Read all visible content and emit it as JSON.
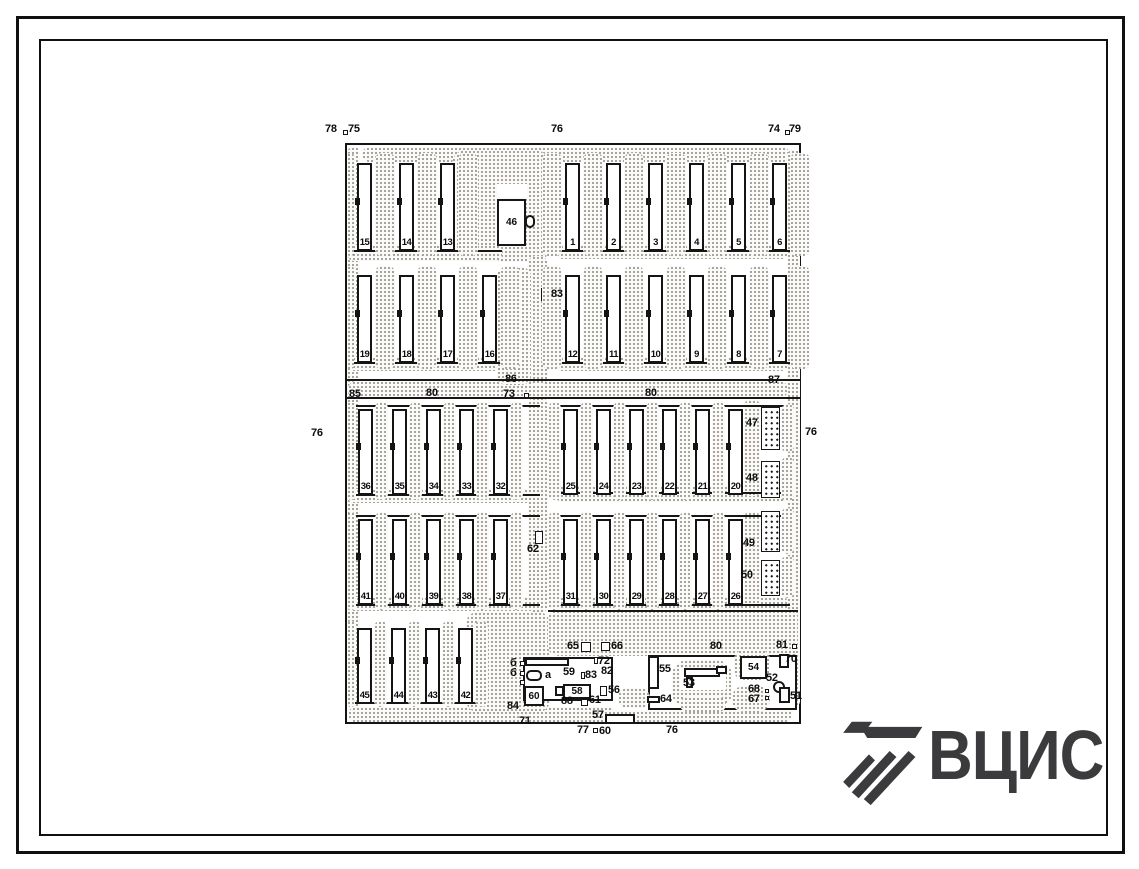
{
  "logo": {
    "text": "ВЦИС",
    "color": "#3b3b3e"
  },
  "colors": {
    "ink": "#141414",
    "paper": "#ffffff",
    "stipple": "#878787"
  },
  "plan": {
    "shapes": [
      {
        "t": "pframe",
        "n": "site-boundary",
        "b": [
          345,
          143,
          456,
          581
        ]
      },
      {
        "t": "stip",
        "n": "road-top",
        "b": [
          362,
          147,
          428,
          15,
          8
        ]
      },
      {
        "t": "stip",
        "n": "road-left",
        "b": [
          347,
          147,
          13,
          562,
          6
        ]
      },
      {
        "t": "stip",
        "n": "road-right",
        "b": [
          787,
          150,
          13,
          557,
          6
        ]
      },
      {
        "t": "stip",
        "n": "road-bottom",
        "b": [
          348,
          707,
          444,
          15,
          8
        ]
      },
      {
        "t": "stip",
        "n": "road-mid",
        "b": [
          348,
          381,
          440,
          17,
          8
        ]
      },
      {
        "t": "stip",
        "n": "plaza-top",
        "b": [
          452,
          150,
          97,
          112,
          14
        ]
      },
      {
        "t": "stip",
        "n": "road-center-upper",
        "b": [
          528,
          256,
          20,
          128,
          8
        ]
      },
      {
        "t": "stip",
        "n": "road-center-lower",
        "b": [
          528,
          397,
          20,
          216,
          8
        ]
      },
      {
        "t": "stip",
        "b": [
          348,
          245,
          154,
          16,
          6
        ]
      },
      {
        "t": "stip",
        "b": [
          556,
          245,
          232,
          14,
          6
        ]
      },
      {
        "t": "stip",
        "b": [
          348,
          357,
          154,
          14,
          6
        ]
      },
      {
        "t": "stip",
        "b": [
          556,
          357,
          232,
          14,
          6
        ]
      },
      {
        "t": "stip",
        "b": [
          497,
          267,
          34,
          118,
          10
        ]
      },
      {
        "t": "stip",
        "b": [
          348,
          489,
          190,
          14,
          6
        ]
      },
      {
        "t": "stip",
        "b": [
          556,
          486,
          232,
          16,
          6
        ]
      },
      {
        "t": "stip",
        "b": [
          348,
          597,
          190,
          14,
          6
        ]
      },
      {
        "t": "stip",
        "b": [
          556,
          597,
          232,
          14,
          6
        ]
      },
      {
        "t": "stip",
        "b": [
          744,
          400,
          16,
          96,
          6
        ]
      },
      {
        "t": "stip",
        "b": [
          744,
          512,
          16,
          94,
          6
        ]
      },
      {
        "t": "stip",
        "n": "plaza-bottom-left",
        "b": [
          466,
          612,
          84,
          100,
          12
        ]
      },
      {
        "t": "stip",
        "n": "service-area",
        "b": [
          548,
          610,
          250,
          46,
          10
        ]
      },
      {
        "t": "line",
        "b": [
          345,
          379,
          456,
          2
        ]
      },
      {
        "t": "line",
        "b": [
          345,
          397,
          456,
          2
        ]
      },
      {
        "t": "line",
        "b": [
          350,
          250,
          152,
          2
        ]
      },
      {
        "t": "line",
        "b": [
          556,
          250,
          234,
          2
        ]
      },
      {
        "t": "line",
        "b": [
          350,
          362,
          152,
          2
        ]
      },
      {
        "t": "line",
        "b": [
          556,
          362,
          234,
          2
        ]
      },
      {
        "t": "line",
        "b": [
          350,
          405,
          190,
          2
        ]
      },
      {
        "t": "line",
        "b": [
          556,
          405,
          234,
          2
        ]
      },
      {
        "t": "line",
        "b": [
          350,
          494,
          190,
          2
        ]
      },
      {
        "t": "line",
        "b": [
          556,
          492,
          234,
          2
        ]
      },
      {
        "t": "line",
        "b": [
          350,
          515,
          190,
          2
        ]
      },
      {
        "t": "line",
        "b": [
          556,
          515,
          234,
          2
        ]
      },
      {
        "t": "line",
        "b": [
          350,
          604,
          190,
          2
        ]
      },
      {
        "t": "line",
        "b": [
          556,
          604,
          234,
          2
        ]
      },
      {
        "t": "line",
        "b": [
          350,
          702,
          128,
          2
        ]
      },
      {
        "t": "line",
        "b": [
          548,
          610,
          250,
          2
        ]
      },
      {
        "t": "hatch",
        "n": "pen-47",
        "b": [
          761,
          407,
          19,
          43
        ]
      },
      {
        "t": "hatch",
        "n": "pen-48",
        "b": [
          761,
          461,
          19,
          37
        ]
      },
      {
        "t": "hatch",
        "n": "pen-49",
        "b": [
          761,
          511,
          19,
          41
        ]
      },
      {
        "t": "hatch",
        "n": "pen-50",
        "b": [
          761,
          560,
          19,
          36
        ]
      },
      {
        "t": "stip",
        "b": [
          781,
          404,
          13,
          48,
          7
        ]
      },
      {
        "t": "stip",
        "b": [
          781,
          457,
          13,
          44,
          7
        ]
      },
      {
        "t": "stip",
        "b": [
          781,
          508,
          13,
          46,
          7
        ]
      },
      {
        "t": "stip",
        "b": [
          781,
          556,
          13,
          42,
          7
        ]
      },
      {
        "t": "wrect",
        "b": [
          497,
          184,
          30,
          13
        ]
      },
      {
        "t": "box",
        "n": "building-46",
        "b": [
          497,
          199,
          29,
          47
        ],
        "label": "46"
      },
      {
        "t": "box",
        "b": [
          525,
          215,
          10,
          13,
          5
        ]
      },
      {
        "t": "box",
        "n": "compound-left",
        "b": [
          523,
          657,
          90,
          44
        ]
      },
      {
        "t": "wrect",
        "b": [
          613,
          656,
          36,
          54
        ]
      },
      {
        "t": "box",
        "n": "compound-right",
        "b": [
          648,
          655,
          149,
          55
        ]
      },
      {
        "t": "stip",
        "b": [
          672,
          660,
          60,
          48,
          16
        ]
      },
      {
        "t": "wrect",
        "b": [
          680,
          668,
          46,
          22
        ]
      },
      {
        "t": "stip",
        "b": [
          734,
          650,
          36,
          30,
          10
        ]
      },
      {
        "t": "stip",
        "b": [
          732,
          686,
          38,
          26,
          12
        ]
      },
      {
        "t": "stip",
        "b": [
          680,
          697,
          46,
          15,
          8
        ]
      },
      {
        "t": "stip",
        "b": [
          618,
          688,
          32,
          20,
          10
        ]
      },
      {
        "t": "box",
        "n": "building-55",
        "b": [
          648,
          656,
          11,
          33
        ]
      },
      {
        "t": "box",
        "n": "building-53",
        "b": [
          684,
          668,
          36,
          9
        ]
      },
      {
        "t": "box",
        "b": [
          686,
          677,
          7,
          11
        ]
      },
      {
        "t": "box",
        "b": [
          716,
          666,
          11,
          8
        ]
      },
      {
        "t": "box",
        "n": "building-54",
        "b": [
          740,
          656,
          27,
          23
        ],
        "label": "54"
      },
      {
        "t": "box",
        "n": "building-52",
        "b": [
          773,
          681,
          12,
          12,
          7
        ]
      },
      {
        "t": "box",
        "n": "building-51",
        "b": [
          779,
          687,
          11,
          16
        ]
      },
      {
        "t": "box",
        "n": "building-70",
        "b": [
          779,
          654,
          10,
          14
        ]
      },
      {
        "t": "box",
        "n": "building-64",
        "b": [
          647,
          696,
          13,
          7
        ]
      },
      {
        "t": "box",
        "n": "building-57",
        "b": [
          605,
          714,
          30,
          10
        ]
      },
      {
        "t": "box",
        "b": [
          525,
          658,
          44,
          8
        ]
      },
      {
        "t": "box",
        "n": "item-a",
        "b": [
          526,
          670,
          16,
          11,
          5
        ]
      },
      {
        "t": "box",
        "b": [
          555,
          686,
          9,
          10
        ]
      },
      {
        "t": "box",
        "n": "building-58",
        "b": [
          563,
          684,
          28,
          15
        ],
        "label": "58"
      },
      {
        "t": "box",
        "n": "building-60",
        "b": [
          524,
          686,
          20,
          20
        ],
        "label": "60"
      },
      {
        "t": "sq",
        "b": [
          343,
          130,
          5,
          5
        ]
      },
      {
        "t": "sq",
        "b": [
          785,
          130,
          5,
          5
        ]
      },
      {
        "t": "sq",
        "n": "marker-83",
        "b": [
          541,
          288,
          8,
          13
        ]
      },
      {
        "t": "sq",
        "n": "marker-62",
        "b": [
          535,
          531,
          8,
          13
        ]
      },
      {
        "t": "sq",
        "b": [
          524,
          393,
          5,
          5
        ]
      },
      {
        "t": "sq",
        "b": [
          792,
          644,
          5,
          5
        ]
      },
      {
        "t": "sq",
        "n": "marker-65",
        "b": [
          581,
          642,
          10,
          10
        ]
      },
      {
        "t": "sq",
        "n": "marker-66",
        "b": [
          601,
          642,
          9,
          9
        ]
      },
      {
        "t": "sq",
        "b": [
          594,
          657,
          4,
          7
        ]
      },
      {
        "t": "sq",
        "b": [
          581,
          672,
          4,
          7
        ]
      },
      {
        "t": "sq",
        "n": "marker-56",
        "b": [
          600,
          686,
          7,
          10
        ]
      },
      {
        "t": "sq",
        "b": [
          520,
          661,
          5,
          5
        ]
      },
      {
        "t": "sq",
        "b": [
          520,
          671,
          5,
          5
        ]
      },
      {
        "t": "sq",
        "b": [
          520,
          680,
          5,
          5
        ]
      },
      {
        "t": "sq",
        "b": [
          581,
          699,
          7,
          7
        ]
      },
      {
        "t": "sq",
        "b": [
          593,
          728,
          5,
          5
        ]
      },
      {
        "t": "sq",
        "b": [
          765,
          689,
          4,
          4
        ]
      },
      {
        "t": "sq",
        "b": [
          765,
          696,
          4,
          4
        ]
      }
    ],
    "groups": [
      {
        "y": 163,
        "h": 88,
        "cy": 153,
        "ch": 103,
        "bw": 15,
        "cw": 20,
        "pad": 3,
        "nums": [
          [
            "15",
            357
          ],
          [
            "14",
            399
          ],
          [
            "13",
            440
          ]
        ]
      },
      {
        "y": 163,
        "h": 88,
        "cy": 153,
        "ch": 103,
        "bw": 15,
        "cw": 20,
        "pad": 3,
        "nums": [
          [
            "1",
            565
          ],
          [
            "2",
            606
          ],
          [
            "3",
            648
          ],
          [
            "4",
            689
          ],
          [
            "5",
            731
          ],
          [
            "6",
            772
          ]
        ]
      },
      {
        "y": 275,
        "h": 88,
        "cy": 266,
        "ch": 103,
        "bw": 15,
        "cw": 20,
        "pad": 3,
        "nums": [
          [
            "19",
            357
          ],
          [
            "18",
            399
          ],
          [
            "17",
            440
          ],
          [
            "16",
            482
          ]
        ]
      },
      {
        "y": 275,
        "h": 88,
        "cy": 266,
        "ch": 103,
        "bw": 15,
        "cw": 20,
        "pad": 3,
        "nums": [
          [
            "12",
            565
          ],
          [
            "11",
            606
          ],
          [
            "10",
            648
          ],
          [
            "9",
            689
          ],
          [
            "8",
            731
          ],
          [
            "7",
            772
          ]
        ]
      },
      {
        "y": 409,
        "h": 86,
        "cy": 402,
        "ch": 98,
        "bw": 15,
        "cw": 13,
        "pad": 2,
        "nums": [
          [
            "36",
            358
          ],
          [
            "35",
            392
          ],
          [
            "34",
            426
          ],
          [
            "33",
            459
          ],
          [
            "32",
            493
          ]
        ]
      },
      {
        "y": 409,
        "h": 86,
        "cy": 402,
        "ch": 98,
        "bw": 15,
        "cw": 13,
        "pad": 2,
        "noTail": true,
        "nums": [
          [
            "25",
            563
          ],
          [
            "24",
            596
          ],
          [
            "23",
            629
          ],
          [
            "22",
            662
          ],
          [
            "21",
            695
          ],
          [
            "20",
            728
          ]
        ]
      },
      {
        "y": 519,
        "h": 86,
        "cy": 512,
        "ch": 98,
        "bw": 15,
        "cw": 13,
        "pad": 2,
        "nums": [
          [
            "41",
            358
          ],
          [
            "40",
            392
          ],
          [
            "39",
            426
          ],
          [
            "38",
            459
          ],
          [
            "37",
            493
          ]
        ]
      },
      {
        "y": 519,
        "h": 86,
        "cy": 512,
        "ch": 98,
        "bw": 15,
        "cw": 13,
        "pad": 2,
        "noTail": true,
        "nums": [
          [
            "31",
            563
          ],
          [
            "30",
            596
          ],
          [
            "29",
            629
          ],
          [
            "28",
            662
          ],
          [
            "27",
            695
          ],
          [
            "26",
            728
          ]
        ]
      },
      {
        "y": 628,
        "h": 76,
        "cy": 621,
        "ch": 86,
        "bw": 15,
        "cw": 13,
        "pad": 2,
        "nums": [
          [
            "45",
            357
          ],
          [
            "44",
            391
          ],
          [
            "43",
            425
          ],
          [
            "42",
            458
          ]
        ]
      }
    ],
    "labels": [
      [
        "78",
        325,
        124
      ],
      [
        "75",
        348,
        124
      ],
      [
        "76",
        551,
        124
      ],
      [
        "74",
        768,
        124
      ],
      [
        "79",
        789,
        124
      ],
      [
        "76",
        311,
        428
      ],
      [
        "76",
        805,
        427
      ],
      [
        "86",
        505,
        374
      ],
      [
        "73",
        503,
        389
      ],
      [
        "85",
        349,
        389
      ],
      [
        "80",
        426,
        388
      ],
      [
        "80",
        645,
        388
      ],
      [
        "87",
        768,
        375
      ],
      [
        "83",
        551,
        289
      ],
      [
        "62",
        527,
        544
      ],
      [
        "47",
        746,
        418
      ],
      [
        "48",
        746,
        473
      ],
      [
        "49",
        743,
        538
      ],
      [
        "50",
        741,
        570
      ],
      [
        "65",
        567,
        641
      ],
      [
        "66",
        611,
        641
      ],
      [
        "72",
        598,
        656
      ],
      [
        "82",
        601,
        666
      ],
      [
        "59",
        563,
        667
      ],
      [
        "83",
        585,
        670
      ],
      [
        "а",
        545,
        670
      ],
      [
        "б",
        510,
        658
      ],
      [
        "б",
        510,
        668
      ],
      [
        "56",
        608,
        685
      ],
      [
        "88",
        561,
        696
      ],
      [
        "61",
        589,
        695
      ],
      [
        "84",
        507,
        701
      ],
      [
        "71",
        519,
        716
      ],
      [
        "57",
        592,
        710
      ],
      [
        "77",
        577,
        725
      ],
      [
        "60",
        599,
        726
      ],
      [
        "76",
        666,
        725
      ],
      [
        "80",
        710,
        641
      ],
      [
        "81",
        776,
        640
      ],
      [
        "55",
        659,
        664
      ],
      [
        "53",
        683,
        678
      ],
      [
        "52",
        766,
        673
      ],
      [
        "68",
        748,
        684
      ],
      [
        "67",
        748,
        694
      ],
      [
        "51",
        790,
        691
      ],
      [
        "70",
        785,
        654
      ],
      [
        "64",
        660,
        694
      ]
    ]
  }
}
